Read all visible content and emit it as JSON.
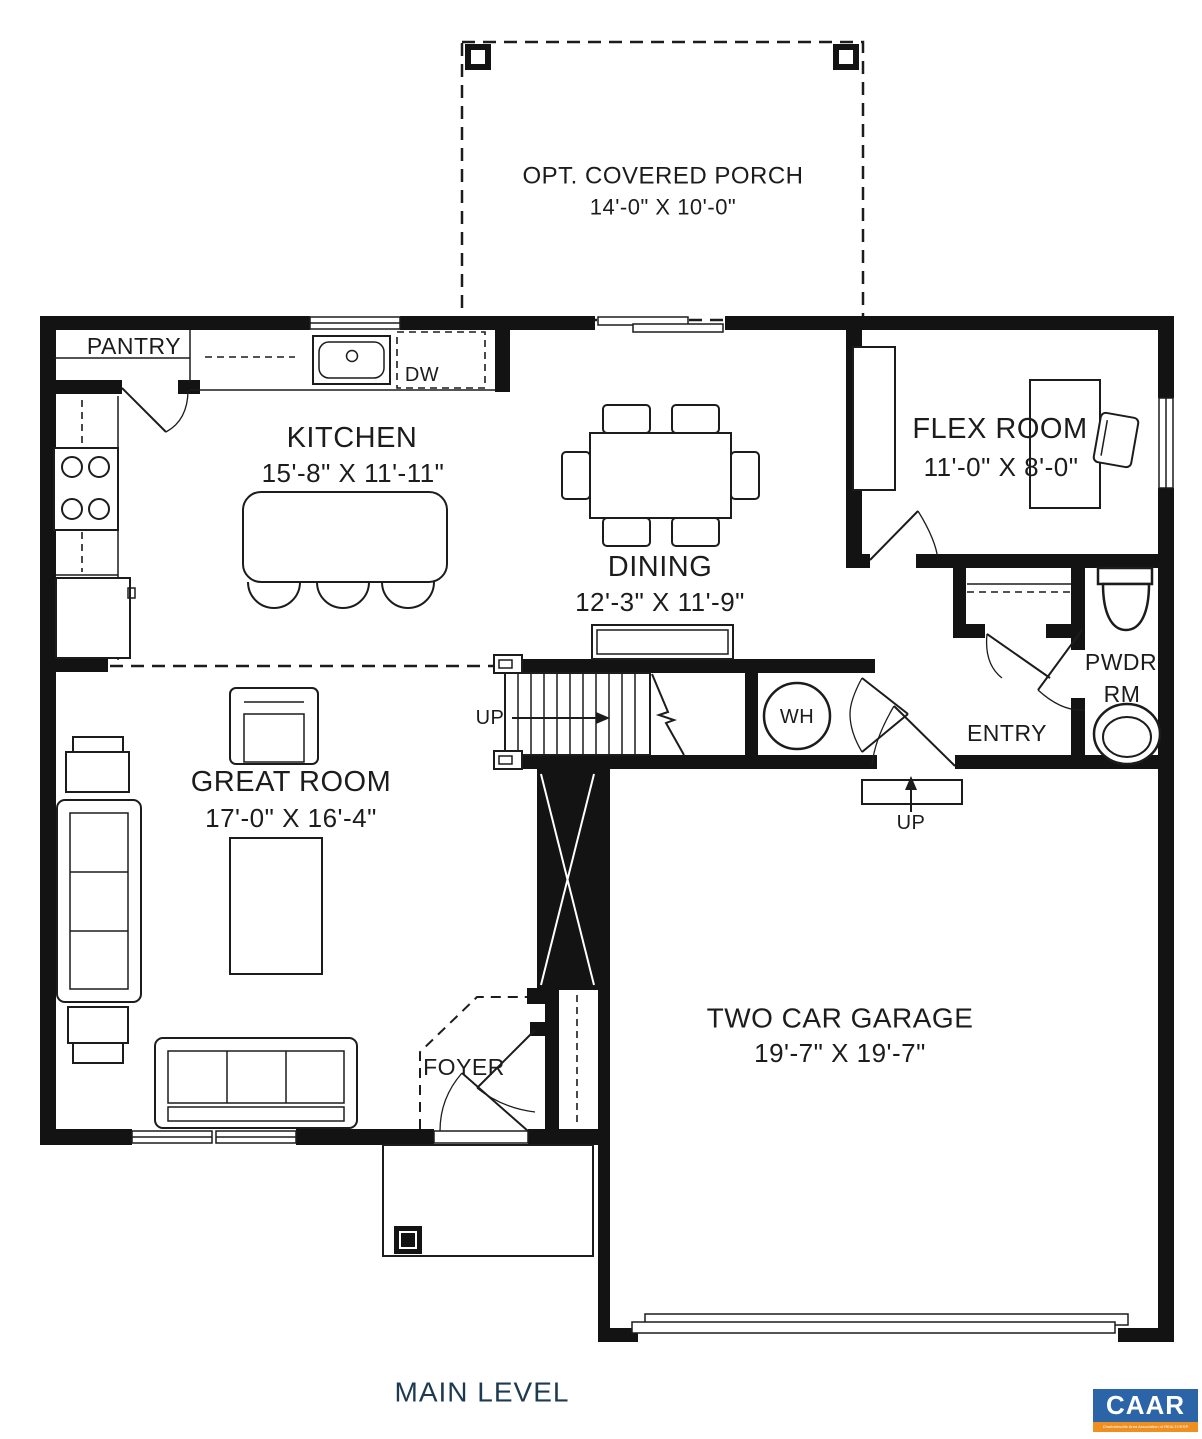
{
  "title": "MAIN LEVEL",
  "rooms": {
    "porch": {
      "name": "OPT. COVERED PORCH",
      "dims": "14'-0\" X 10'-0\""
    },
    "pantry": {
      "name": "PANTRY"
    },
    "kitchen": {
      "name": "KITCHEN",
      "dims": "15'-8\" X 11'-11\""
    },
    "dining": {
      "name": "DINING",
      "dims": "12'-3\" X 11'-9\""
    },
    "flex": {
      "name": "FLEX ROOM",
      "dims": "11'-0\" X 8'-0\""
    },
    "powder": {
      "name_line1": "PWDR",
      "name_line2": "RM"
    },
    "entry": {
      "name": "ENTRY"
    },
    "great_room": {
      "name": "GREAT ROOM",
      "dims": "17'-0\" X 16'-4\""
    },
    "foyer": {
      "name": "FOYER"
    },
    "garage": {
      "name": "TWO CAR GARAGE",
      "dims": "19'-7\" X 19'-7\""
    }
  },
  "annotations": {
    "up_stairs": "UP",
    "up_garage": "UP",
    "water_heater": "WH",
    "dishwasher": "DW"
  },
  "logo": {
    "text": "CAAR",
    "tagline": "Charlottesville Area Association of REALTORS®"
  },
  "colors": {
    "line": "#1c1c1c",
    "title_navy": "#1d3b50",
    "logo_blue": "#2b64a7",
    "logo_orange": "#ef8f1f"
  }
}
